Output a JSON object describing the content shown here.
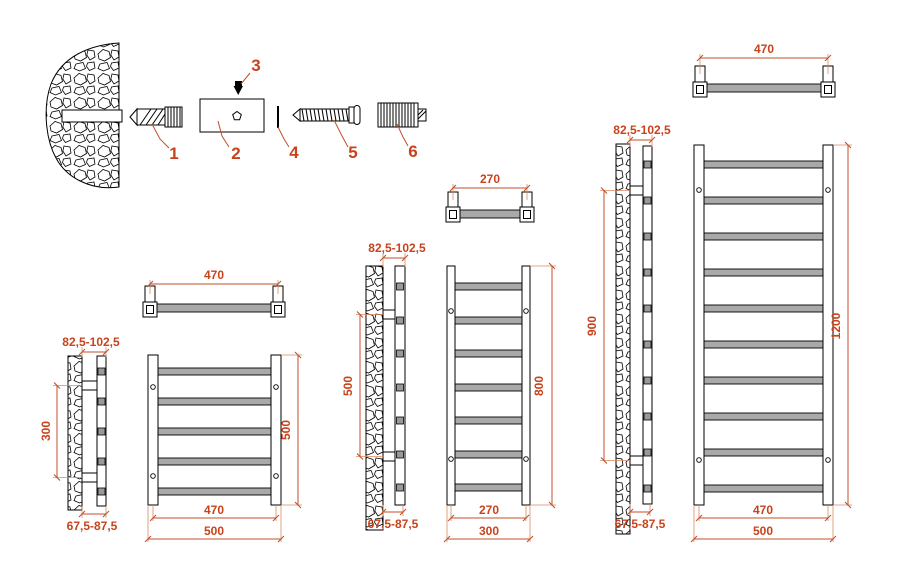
{
  "drawing": {
    "kind": "heated towel rail mounting & dimension drawing",
    "colors": {
      "dimension_text": "#c8431c",
      "dimension_line": "#c0502a",
      "bar_fill": "#a9a9a9"
    }
  },
  "hardware": {
    "items": [
      "1",
      "2",
      "3",
      "4",
      "5",
      "6"
    ]
  },
  "top_views": {
    "small": "470",
    "medium": "270",
    "large": "470"
  },
  "models": {
    "small": {
      "wall_gap_top": "82,5-102,5",
      "bracket_span": "300",
      "wall_gap_bottom": "67,5-87,5",
      "height": "500",
      "rail_width": "470",
      "overall_width": "500"
    },
    "medium": {
      "wall_gap_top": "82,5-102,5",
      "bracket_span": "500",
      "wall_gap_bottom": "67,5-87,5",
      "height": "800",
      "rail_width": "270",
      "overall_width": "300"
    },
    "large": {
      "wall_gap_top": "82,5-102,5",
      "bracket_span": "900",
      "wall_gap_bottom": "67,5-87,5",
      "height": "1200",
      "rail_width": "470",
      "overall_width": "500"
    }
  }
}
